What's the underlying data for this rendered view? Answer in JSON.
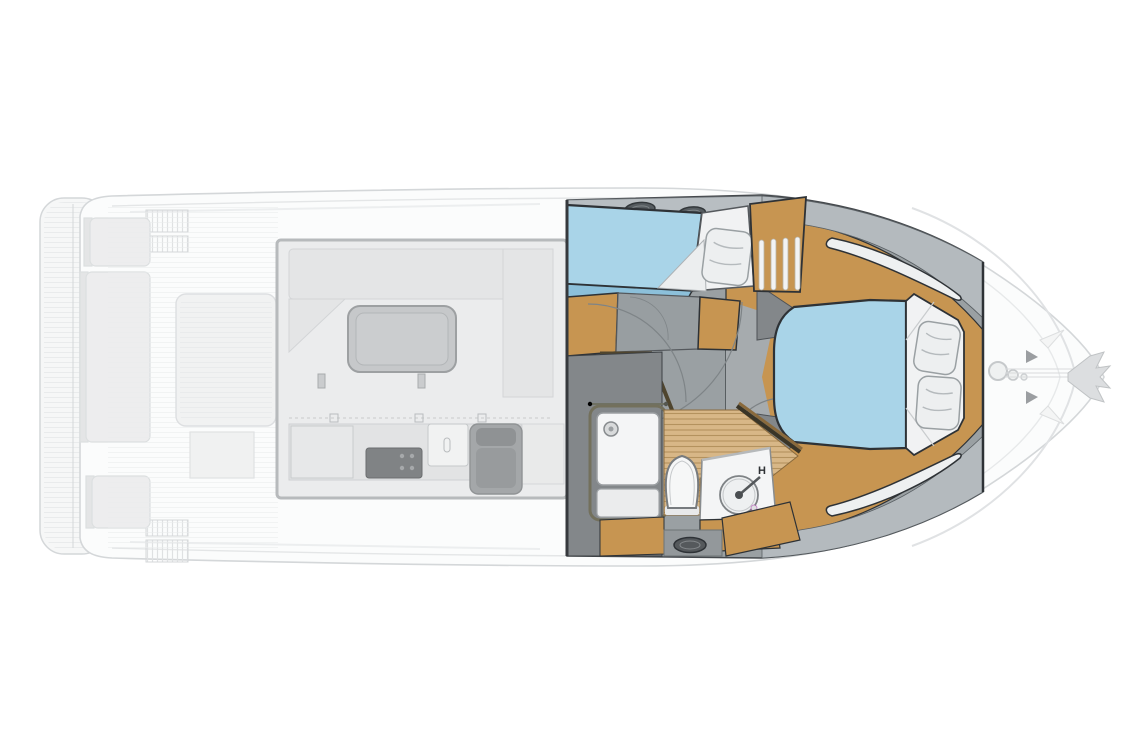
{
  "diagram": {
    "subject": "motor-yacht deck and lower-deck floor plan",
    "orientation": "bow-right",
    "areas": [
      "swim-platform",
      "cockpit-seating",
      "salon-galley",
      "helm-seat",
      "guest-cabin",
      "companionway",
      "head-bathroom",
      "owner-cabin",
      "bow-anchor-gear"
    ]
  },
  "labels": {
    "hot_water": "H"
  },
  "colors": {
    "ghost_stroke": "#d4d7d9",
    "ghost_stroke_dark": "#b7babc",
    "ghost_fill": "#f6f7f7",
    "ghost_fill_2": "#ededee",
    "ghost_fill_3": "#e4e5e6",
    "salon_fill": "#ebeced",
    "table_gray": "#c6c8ca",
    "stove_dark": "#808385",
    "helm_gray": "#a4a7a9",
    "outline_dark": "#2e3236",
    "wood": "#c79551",
    "wood_dark": "#8a6a3c",
    "wood_beam": "#4f452e",
    "bed_blue": "#a9d4e8",
    "bed_blue_dark": "#8cc0da",
    "bedding_white": "#f1f2f3",
    "pillow": "#edeff0",
    "pillow_line": "#b5babd",
    "deck_band": "#b8bec2",
    "cabin_gray": "#9aa0a3",
    "floor_gray": "#a6abae",
    "wall_dark": "#83878a",
    "wall_mid": "#8f9497",
    "hatch_dark": "#565c60",
    "teak": "#d8b787",
    "teak_stripe": "#b4925e",
    "fixture_white": "#f4f5f6",
    "fixture_stroke": "#85898c",
    "window_white": "#eef0f1"
  }
}
